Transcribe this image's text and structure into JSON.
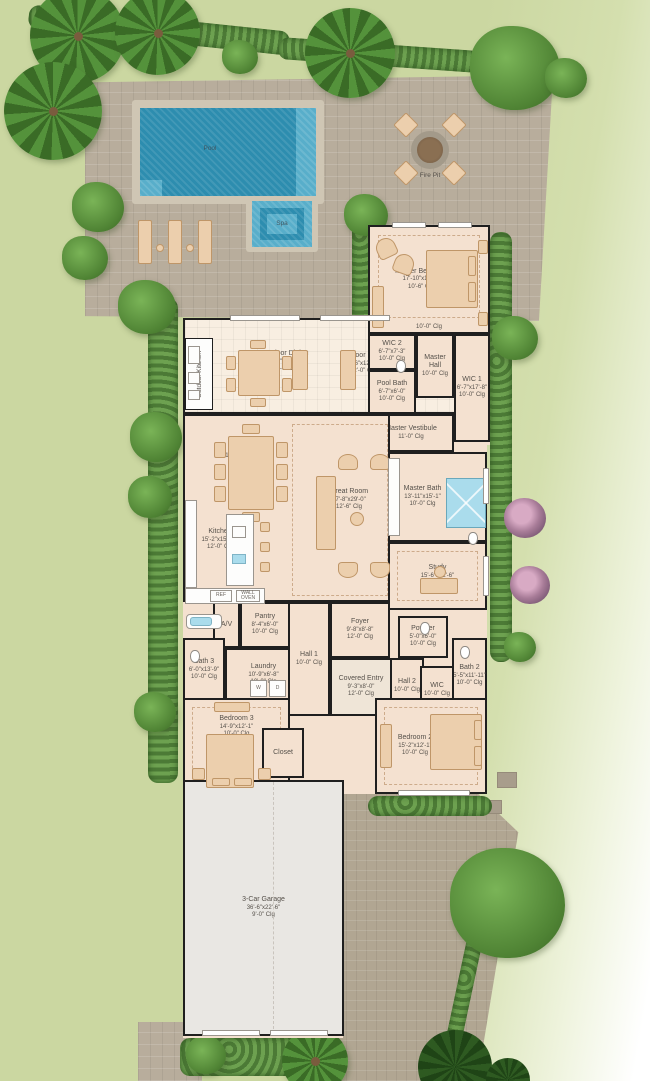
{
  "site": {
    "pool_label": "Pool",
    "spa_label": "Spa",
    "fire_pit_label": "Fire Pit"
  },
  "appliances": {
    "ref": "REF",
    "wall_oven": "WALL OVEN",
    "washer": "W",
    "dryer": "D"
  },
  "rooms": {
    "master_bedroom": {
      "name": "Master Bedroom",
      "dims": "17'-10\"x15'-1\"",
      "clg": "10'-6\" Clg",
      "tray_clg": "10'-0\" Clg"
    },
    "wic2": {
      "name": "WIC 2",
      "dims": "6'-7\"x7'-3\"",
      "clg": "10'-0\" Clg"
    },
    "master_hall": {
      "name": "Master Hall",
      "clg": "10'-0\" Clg"
    },
    "wic1": {
      "name": "WIC 1",
      "dims": "6'-7\"x17'-8\"",
      "clg": "10'-0\" Clg"
    },
    "pool_bath": {
      "name": "Pool Bath",
      "dims": "6'-7\"x6'-0\"",
      "clg": "10'-0\" Clg"
    },
    "master_vestibule": {
      "name": "Master Vestibule",
      "clg": "11'-0\" Clg"
    },
    "master_bath": {
      "name": "Master Bath",
      "dims": "13'-11\"x15'-1\"",
      "clg": "10'-0\" Clg"
    },
    "study": {
      "name": "Study",
      "dims": "15'-6\"x12'-6\"",
      "clg": "10'-6\" Clg"
    },
    "outdoor_kitchen": {
      "name": "Outdoor Kitchen"
    },
    "outdoor_dining": {
      "name": "Outdoor Dining",
      "dims": "13'-6\"x12'-11\"",
      "clg": "12'-0\" Clg"
    },
    "outdoor_living": {
      "name": "Outdoor Living",
      "dims": "14'-6\"x12'-11\"",
      "clg": "12'-0\" Clg"
    },
    "dining": {
      "name": "Dining",
      "dims": "15'-2\"x15'-1\"",
      "clg": "12'-0\" Clg"
    },
    "great_room": {
      "name": "Great Room",
      "dims": "17'-8\"x29'-0\"",
      "clg": "12'-6\" Clg"
    },
    "kitchen": {
      "name": "Kitchen",
      "dims": "15'-2\"x15'-10\"",
      "clg": "12'-0\" Clg"
    },
    "pantry": {
      "name": "Pantry",
      "dims": "8'-4\"x6'-0\"",
      "clg": "10'-0\" Clg"
    },
    "av": {
      "name": "A/V"
    },
    "laundry": {
      "name": "Laundry",
      "dims": "10'-9\"x6'-8\"",
      "clg": "10'-0\" Clg"
    },
    "bath3": {
      "name": "Bath 3",
      "dims": "6'-0\"x13'-9\"",
      "clg": "10'-0\" Clg"
    },
    "hall1": {
      "name": "Hall 1",
      "clg": "10'-0\" Clg"
    },
    "foyer": {
      "name": "Foyer",
      "dims": "9'-8\"x8'-8\"",
      "clg": "12'-0\" Clg"
    },
    "covered_entry": {
      "name": "Covered Entry",
      "dims": "9'-3\"x8'-0\"",
      "clg": "12'-0\" Clg"
    },
    "powder": {
      "name": "Powder",
      "dims": "5'-0\"x6'-0\"",
      "clg": "10'-0\" Clg"
    },
    "hall2": {
      "name": "Hall 2",
      "clg": "10'-0\" Clg"
    },
    "bath2": {
      "name": "Bath 2",
      "dims": "5'-5\"x11'-11\"",
      "clg": "10'-0\" Clg"
    },
    "wic_bed2": {
      "name": "WIC",
      "clg": "10'-0\" Clg"
    },
    "bedroom2": {
      "name": "Bedroom 2",
      "dims": "15'-2\"x12'-1\"",
      "clg": "10'-0\" Clg"
    },
    "bedroom3": {
      "name": "Bedroom 3",
      "dims": "14'-9\"x12'-1\"",
      "clg": "10'-0\" Clg"
    },
    "closet": {
      "name": "Closet"
    },
    "garage": {
      "name": "3-Car Garage",
      "dims": "36'-6\"x22'-6\"",
      "clg": "9'-0\" Clg"
    }
  },
  "colors": {
    "lawn": "#cbd7a1",
    "hedge": "#568540",
    "paver": "#b8ad9c",
    "pool_water": "#2d8daf",
    "spa_water": "#5fb9d2",
    "floor": "#f4e1d0",
    "lanai_floor": "#f8eee1",
    "garage_floor": "#e9e7e3",
    "wall": "#1f1f1f",
    "furniture": "#eccfad"
  }
}
